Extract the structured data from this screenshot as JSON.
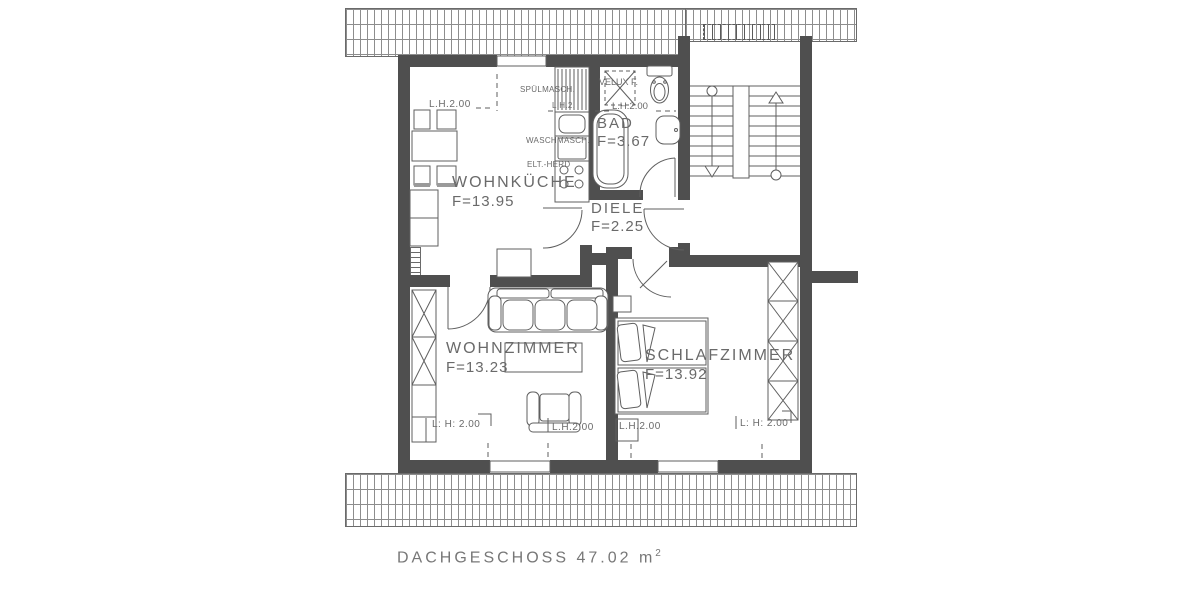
{
  "plan_title": {
    "main": "DACHGESCHOSS  47.02 m",
    "sup": "2"
  },
  "rooms": {
    "kitchen": {
      "name": "WOHNKÜCHE",
      "area": "F=13.95"
    },
    "bath": {
      "name": "BAD",
      "area": "F=3.67"
    },
    "hall": {
      "name": "DIELE",
      "area": "F=2.25"
    },
    "living": {
      "name": "WOHNZIMMER",
      "area": "F=13.23"
    },
    "bedroom": {
      "name": "SCHLAFZIMMER",
      "area": "F=13.92"
    }
  },
  "labels": {
    "kitchen_lh": "L.H.2.00",
    "kitchen_lh_small": "L.H.2.",
    "bath_lh": "L.H.2.00",
    "velux": "VELUX F.",
    "dishwasher": "SPÜLMASCH.",
    "washing_machine": "WASCHMASCH.",
    "stove": "ELT.-HERD",
    "living_lh_left": "L: H: 2.00",
    "living_lh_center": "L.H.2.00",
    "bedroom_lh_left": "L.H.2.00",
    "bedroom_lh_right": "L: H: 2.00"
  },
  "colors": {
    "wall": "#4f4f4f",
    "line": "#5f5f5f",
    "text": "#6a6a6a",
    "background": "#ffffff"
  }
}
